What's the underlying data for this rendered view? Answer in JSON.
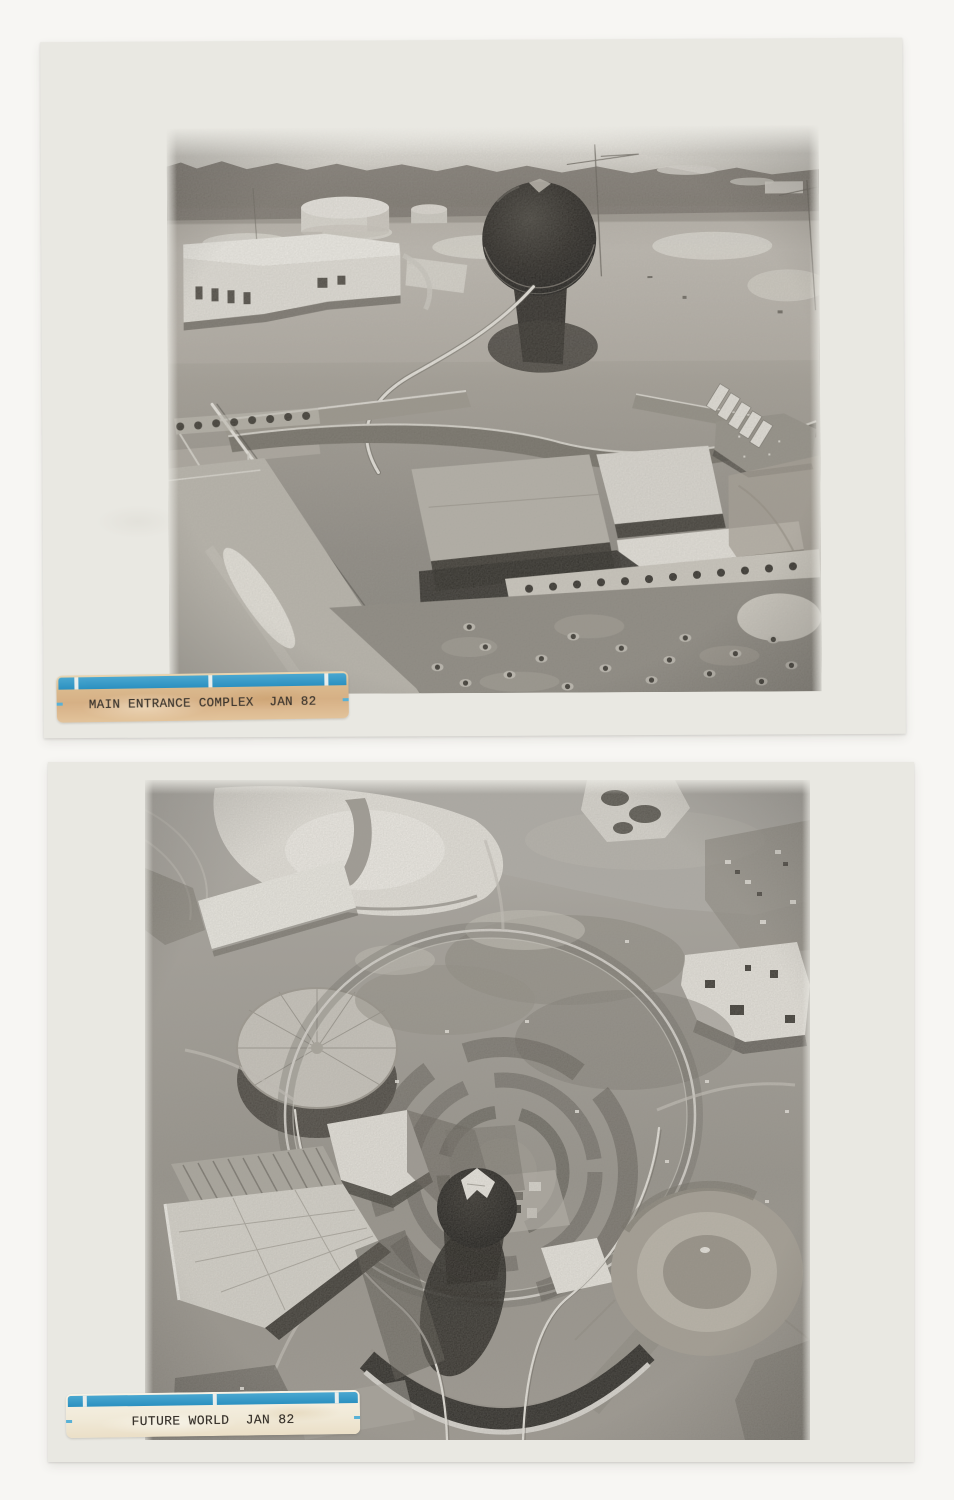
{
  "page": {
    "background_color": "#f7f6f3",
    "print_paper_color": "#e9e8e2"
  },
  "prints": [
    {
      "id": "main-entrance",
      "caption": "MAIN ENTRANCE COMPLEX  JAN 82",
      "tape": {
        "stripe_color": "#2e97c6",
        "body_color": "#d9b78c",
        "text_color": "#38322b"
      }
    },
    {
      "id": "future-world",
      "caption": "FUTURE WORLD  JAN 82",
      "tape": {
        "stripe_color": "#2e97c6",
        "body_color": "#f0e9d7",
        "text_color": "#38322b"
      }
    }
  ]
}
